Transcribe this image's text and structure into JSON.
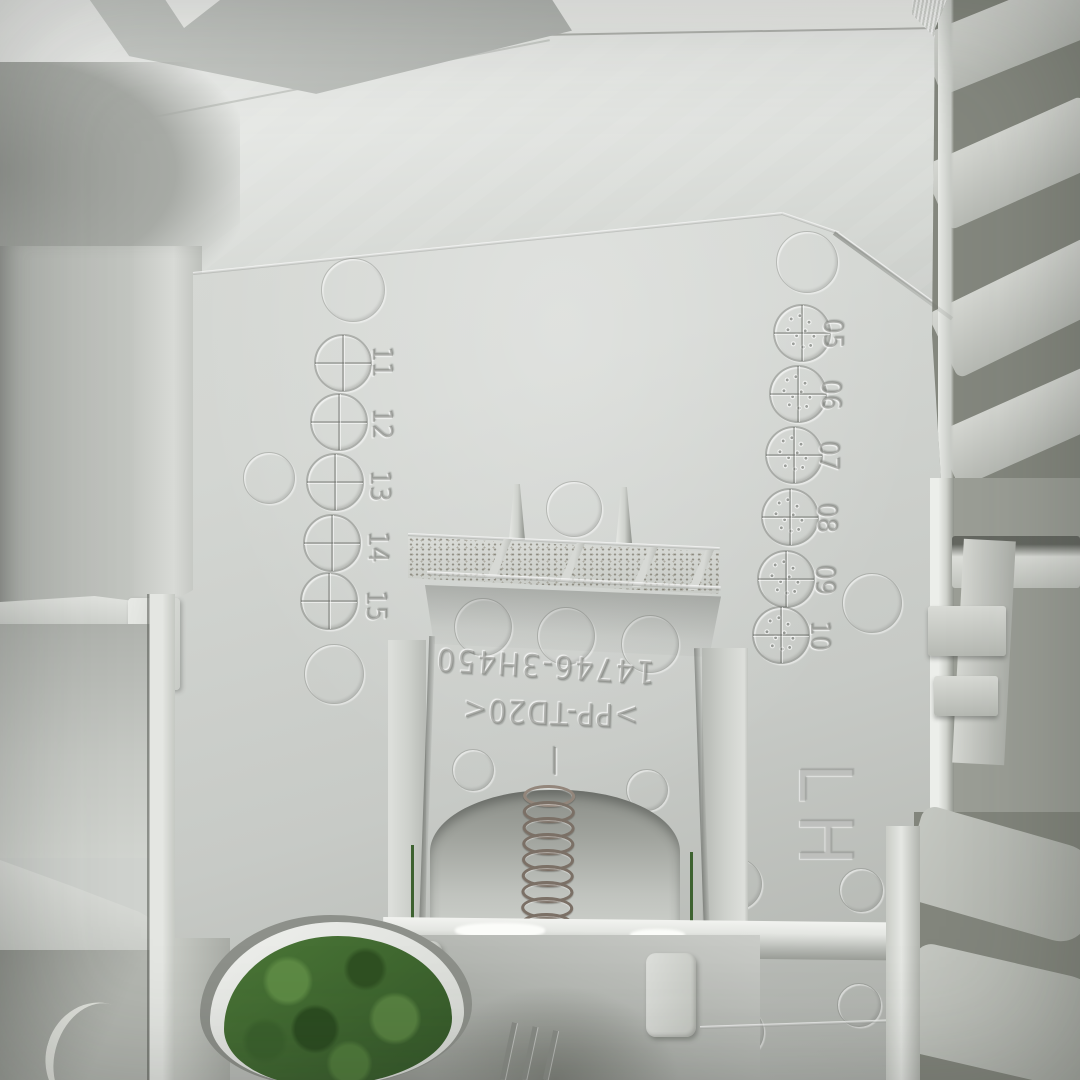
{
  "scene": {
    "description": "Back side of a light-gray molded plastic trim panel lying on artificial turf, with a metal coil spring in a central bracket, molded date wheels and part markings"
  },
  "markings": {
    "part_number": "14746-3H450",
    "material_code": ">PP-TD20<",
    "hand_code": "LH",
    "cavity_tick": "|",
    "date_wheel_numbers": [
      "11",
      "12",
      "13",
      "14",
      "15"
    ],
    "date_clock_numbers": [
      "05",
      "06",
      "07",
      "08",
      "09",
      "10"
    ]
  },
  "colors": {
    "plastic_light": "#e9ebe8",
    "plastic_base": "#cfd2ce",
    "plastic_shadow": "#9a9d98",
    "rib_dark": "#84877e",
    "turf_green": "#46702f",
    "spring_metal": "#7b7066"
  }
}
